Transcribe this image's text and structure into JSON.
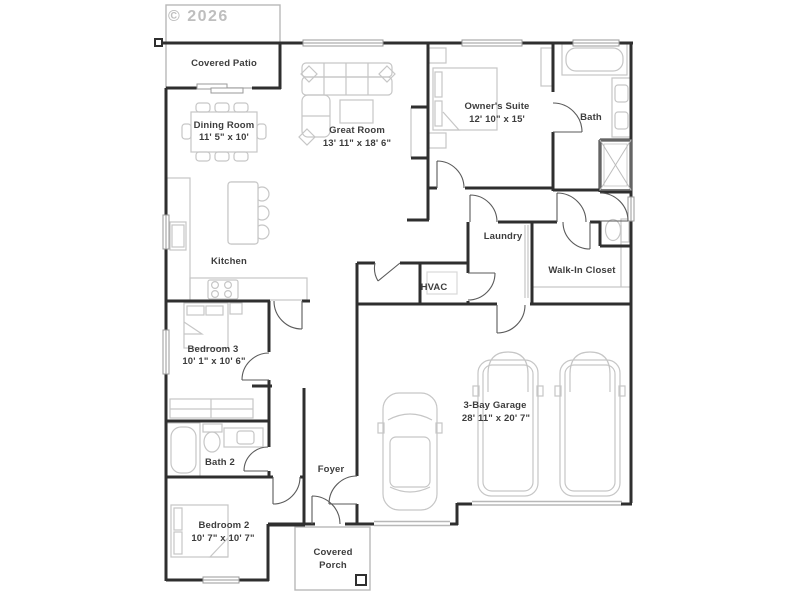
{
  "watermark": "© 2026",
  "rooms": {
    "covered_patio": {
      "name": "Covered Patio"
    },
    "dining_room": {
      "name": "Dining Room",
      "dims": "11' 5\" x 10'"
    },
    "great_room": {
      "name": "Great Room",
      "dims": "13' 11\" x 18' 6\""
    },
    "owners_suite": {
      "name": "Owner's Suite",
      "dims": "12' 10\" x 15'"
    },
    "bath": {
      "name": "Bath"
    },
    "laundry": {
      "name": "Laundry"
    },
    "walk_in_closet": {
      "name": "Walk-In Closet"
    },
    "hvac": {
      "name": "HVAC"
    },
    "kitchen": {
      "name": "Kitchen"
    },
    "bedroom_3": {
      "name": "Bedroom 3",
      "dims": "10' 1\" x 10' 6\""
    },
    "bath_2": {
      "name": "Bath 2"
    },
    "foyer": {
      "name": "Foyer"
    },
    "bedroom_2": {
      "name": "Bedroom 2",
      "dims": "10' 7\" x 10' 7\""
    },
    "covered_porch": {
      "name_line1": "Covered",
      "name_line2": "Porch"
    },
    "garage": {
      "name": "3-Bay Garage",
      "dims": "28' 11\" x 20' 7\""
    }
  },
  "colors": {
    "wall": "#2f2f2f",
    "furniture": "#c6c6c6",
    "slab": "#b8b8b8",
    "door": "#5a5a5a",
    "window_frame": "#9a9a9a",
    "label": "#3d3d3d",
    "watermark": "#aeaeae"
  }
}
